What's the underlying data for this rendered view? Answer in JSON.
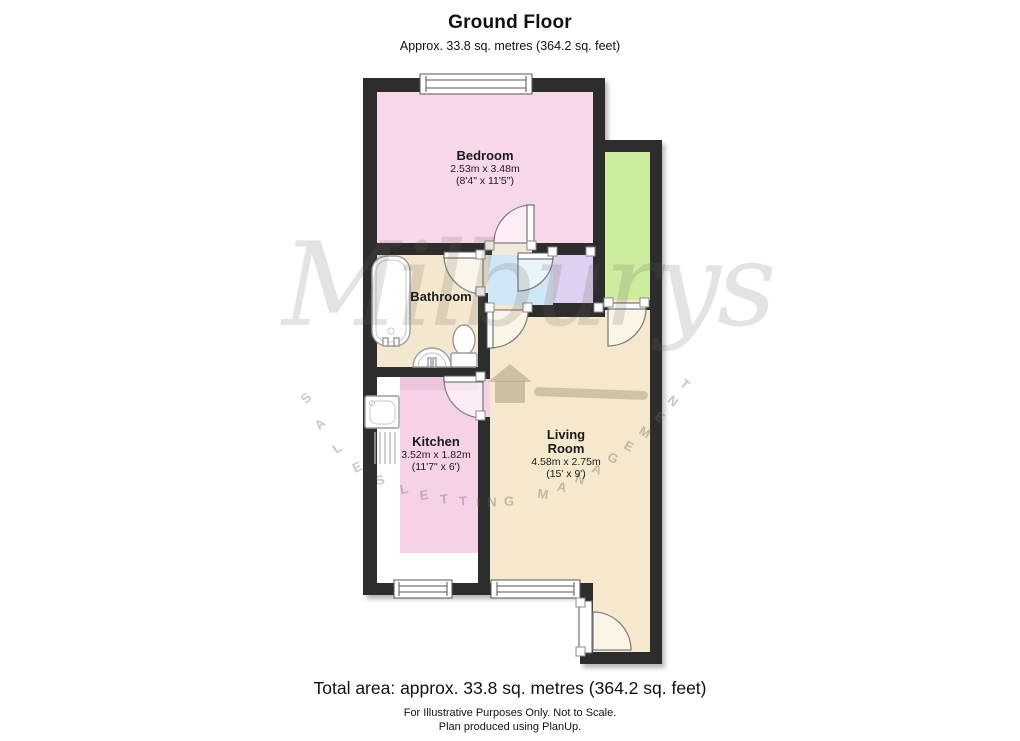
{
  "header": {
    "title": "Ground Floor",
    "subtitle": "Approx. 33.8 sq. metres (364.2 sq. feet)"
  },
  "rooms": {
    "bedroom": {
      "name": "Bedroom",
      "metric": "2.53m x 3.48m",
      "imperial": "(8'4\" x 11'5\")"
    },
    "bathroom": {
      "name": "Bathroom"
    },
    "kitchen": {
      "name": "Kitchen",
      "metric": "3.52m x 1.82m",
      "imperial": "(11'7\" x 6')"
    },
    "living": {
      "name_line1": "Living",
      "name_line2": "Room",
      "metric": "4.58m x 2.75m",
      "imperial": "(15' x 9')"
    }
  },
  "watermark": {
    "brand": "Milburys",
    "words": "SALES LETTING MANAGEMENT",
    "arc_letters": [
      {
        "ch": "S",
        "x": 306,
        "y": 398,
        "r": -50
      },
      {
        "ch": "A",
        "x": 320,
        "y": 424,
        "r": -42
      },
      {
        "ch": "L",
        "x": 337,
        "y": 448,
        "r": -34
      },
      {
        "ch": "E",
        "x": 357,
        "y": 467,
        "r": -26
      },
      {
        "ch": "S",
        "x": 380,
        "y": 480,
        "r": -18
      },
      {
        "ch": "L",
        "x": 404,
        "y": 489,
        "r": -13
      },
      {
        "ch": "E",
        "x": 424,
        "y": 495,
        "r": -10
      },
      {
        "ch": "T",
        "x": 444,
        "y": 499,
        "r": -7
      },
      {
        "ch": "T",
        "x": 463,
        "y": 501,
        "r": -4
      },
      {
        "ch": "I",
        "x": 478,
        "y": 502,
        "r": -2
      },
      {
        "ch": "N",
        "x": 492,
        "y": 502,
        "r": 0
      },
      {
        "ch": "G",
        "x": 509,
        "y": 501,
        "r": 2
      },
      {
        "ch": "M",
        "x": 543,
        "y": 494,
        "r": 8
      },
      {
        "ch": "A",
        "x": 562,
        "y": 487,
        "r": 12
      },
      {
        "ch": "N",
        "x": 580,
        "y": 479,
        "r": 16
      },
      {
        "ch": "A",
        "x": 597,
        "y": 469,
        "r": 20
      },
      {
        "ch": "G",
        "x": 613,
        "y": 458,
        "r": 24
      },
      {
        "ch": "E",
        "x": 629,
        "y": 446,
        "r": 28
      },
      {
        "ch": "M",
        "x": 645,
        "y": 432,
        "r": 32
      },
      {
        "ch": "E",
        "x": 660,
        "y": 417,
        "r": 36
      },
      {
        "ch": "N",
        "x": 673,
        "y": 401,
        "r": 40
      },
      {
        "ch": "T",
        "x": 685,
        "y": 384,
        "r": 44
      }
    ]
  },
  "footer": {
    "total": "Total area: approx. 33.8 sq. metres (364.2 sq. feet)",
    "disclaimer": "For Illustrative Purposes Only. Not to Scale.",
    "produced": "Plan produced using PlanUp."
  },
  "colors": {
    "wall": "#2d2d2d",
    "bedroom": "#f8d7ea",
    "kitchen": "#f6d2e7",
    "kitchen_counter": "#eac5dd",
    "kitchen_units": "#ffffff",
    "bathroom": "#f4e7cf",
    "living": "#f5e8cd",
    "hall": "#cfe7f6",
    "cupboard": "#ddd0f0",
    "store": "#cdec9e",
    "doorway": "#f1e9dc",
    "window": "#ffffff"
  }
}
